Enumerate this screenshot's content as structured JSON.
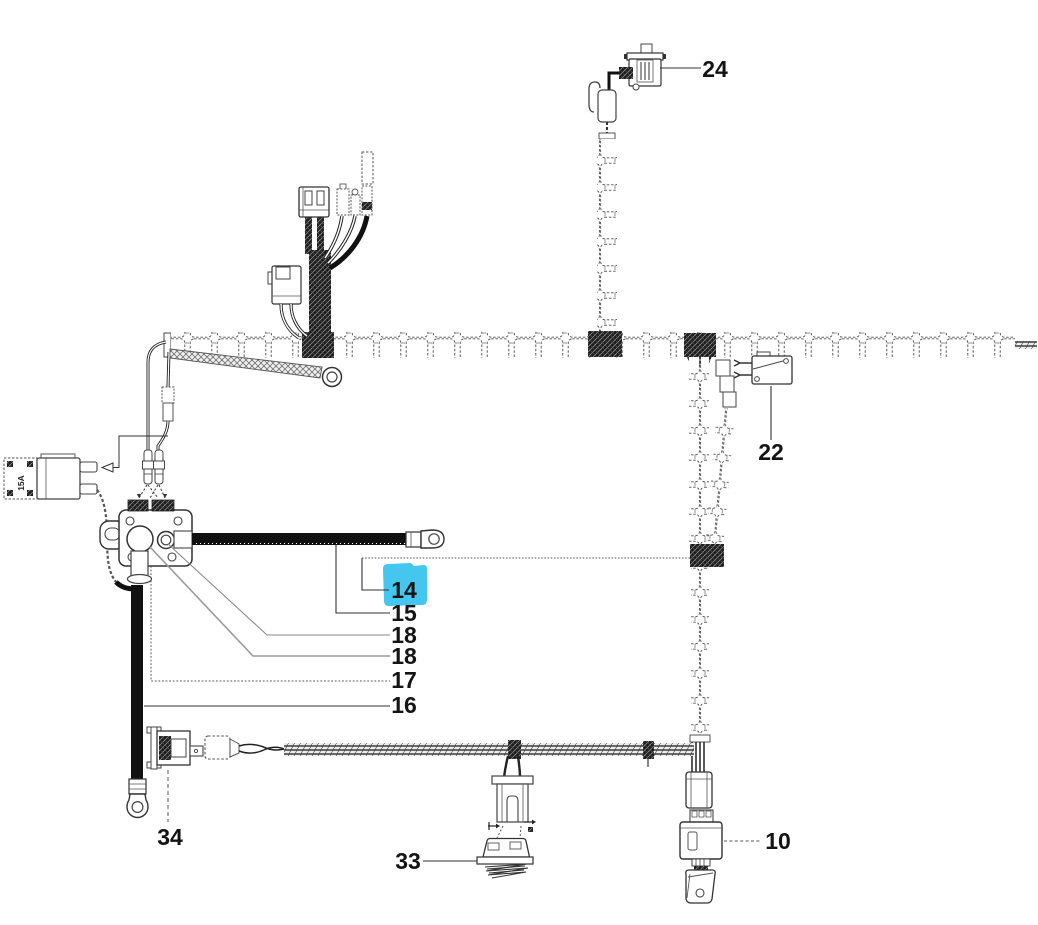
{
  "diagram": {
    "background": "#ffffff",
    "line_color": "#1a1a1a",
    "highlight_color": "#45c6ee",
    "selected_part": "14"
  },
  "callouts": {
    "part24": {
      "label": "24",
      "highlighted": false
    },
    "part22": {
      "label": "22",
      "highlighted": false
    },
    "part14": {
      "label": "14",
      "highlighted": true
    },
    "part15": {
      "label": "15",
      "highlighted": false
    },
    "part18a": {
      "label": "18",
      "highlighted": false
    },
    "part18b": {
      "label": "18",
      "highlighted": false
    },
    "part17": {
      "label": "17",
      "highlighted": false
    },
    "part16": {
      "label": "16",
      "highlighted": false
    },
    "part34": {
      "label": "34",
      "highlighted": false
    },
    "part33": {
      "label": "33",
      "highlighted": false
    },
    "part10": {
      "label": "10",
      "highlighted": false
    }
  },
  "markings": {
    "fuse_rating": "15A"
  }
}
